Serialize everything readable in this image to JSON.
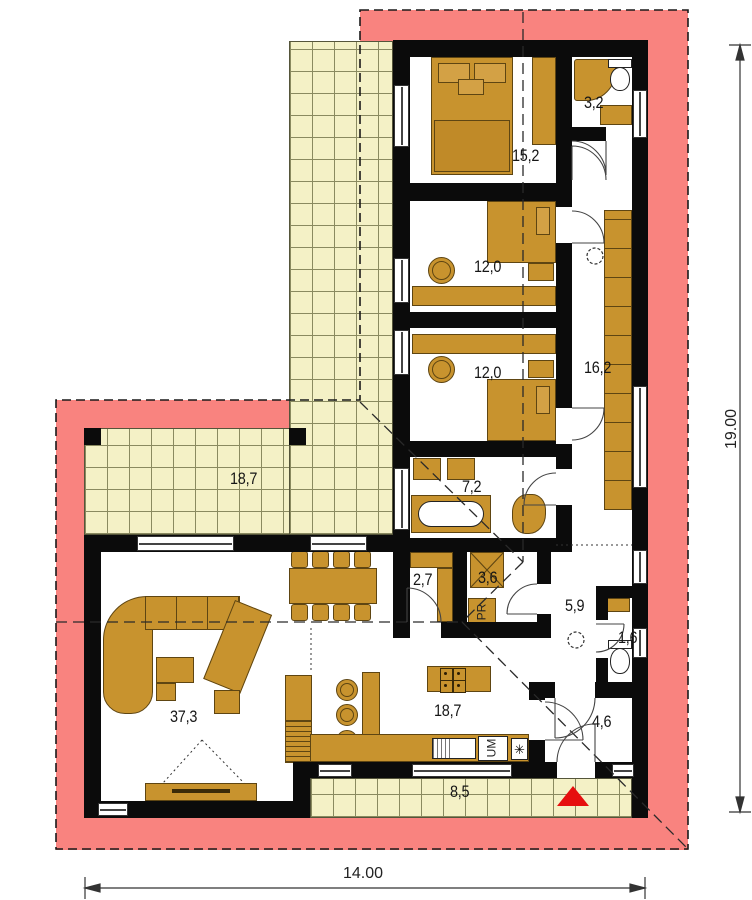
{
  "title": "Bungalow floor plan",
  "rooms": [
    {
      "id": "bathroom-top",
      "area": "3,2"
    },
    {
      "id": "bedroom-master",
      "area": "15,2"
    },
    {
      "id": "bedroom-2",
      "area": "12,0"
    },
    {
      "id": "bedroom-3",
      "area": "12,0"
    },
    {
      "id": "corridor",
      "area": "16,2"
    },
    {
      "id": "terrace",
      "area": "18,7"
    },
    {
      "id": "bathroom-main",
      "area": "7,2"
    },
    {
      "id": "closet",
      "area": "2,7"
    },
    {
      "id": "laundry-shower",
      "area": "3,6"
    },
    {
      "id": "hall",
      "area": "5,9"
    },
    {
      "id": "wc",
      "area": "1,6"
    },
    {
      "id": "living-room",
      "area": "37,3"
    },
    {
      "id": "kitchen-dining",
      "area": "18,7"
    },
    {
      "id": "entry",
      "area": "4,6"
    },
    {
      "id": "porch",
      "area": "8,5"
    }
  ],
  "appliances": {
    "washing_machine": "PR",
    "dishwasher": "UM",
    "vent_symbol": "✳"
  },
  "dimensions": {
    "width": "14.00",
    "depth": "19.00"
  },
  "colors": {
    "roof_overhang": "#f9837f",
    "terrace_tile": "#f4f1c6",
    "furniture": "#c8932e",
    "wall": "#0b0b0b",
    "entrance_marker": "#e60f0f"
  }
}
